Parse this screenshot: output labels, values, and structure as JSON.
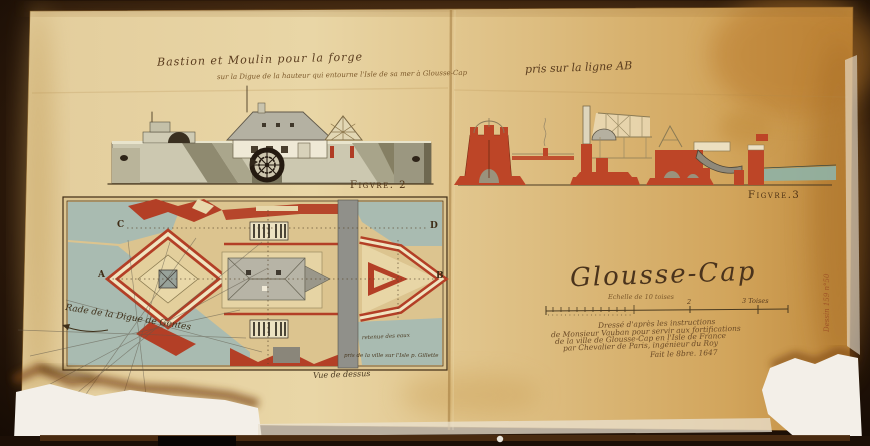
{
  "document": {
    "title_line1": "Bastion et Moulin pour la forge",
    "title_line2": "sur la Digue de la hauteur qui entourne l'Isle de sa mer à Glousse-Cap",
    "section_note": "pris sur la ligne AB",
    "figure2_label": "Figvre. 2",
    "figure3_label": "Figvre.3",
    "map_title": "Glousse-Cap",
    "scale": {
      "caption": "Echelle de 10 toises",
      "mid_value": "2",
      "end_value": "3 Toises"
    },
    "attribution": {
      "line1": "Dressé d'après les instructions",
      "line2": "de Monsieur Vauban pour servir aux fortifications",
      "line3": "de la ville de Glousse-Cap en l'Isle de France",
      "line4": "par Chevalier de Paris, ingénieur du Roy",
      "line5": "Fait le 8bre. 1647"
    },
    "margin_note": "Dessin 159 n°50",
    "plan": {
      "corner_a": "A",
      "corner_b": "B",
      "corner_c": "C",
      "corner_d": "D",
      "water_note": "Rade de la Digue de Gentes",
      "note_retenue": "retenue des eaux",
      "note_prise": "pris de la ville sur l'Isle p. Gillette",
      "caption": "Vue de dessus"
    },
    "palette": {
      "paper_light": "#ecd8a8",
      "paper_amber": "#d2a55c",
      "ink_brown": "#5a3c1e",
      "masonry_red": "#b8432a",
      "water_teal": "#a4b8ae",
      "wall_gray": "#c9c5ae",
      "tear_white": "#f3efe8",
      "backing_dark": "#23130a"
    }
  }
}
